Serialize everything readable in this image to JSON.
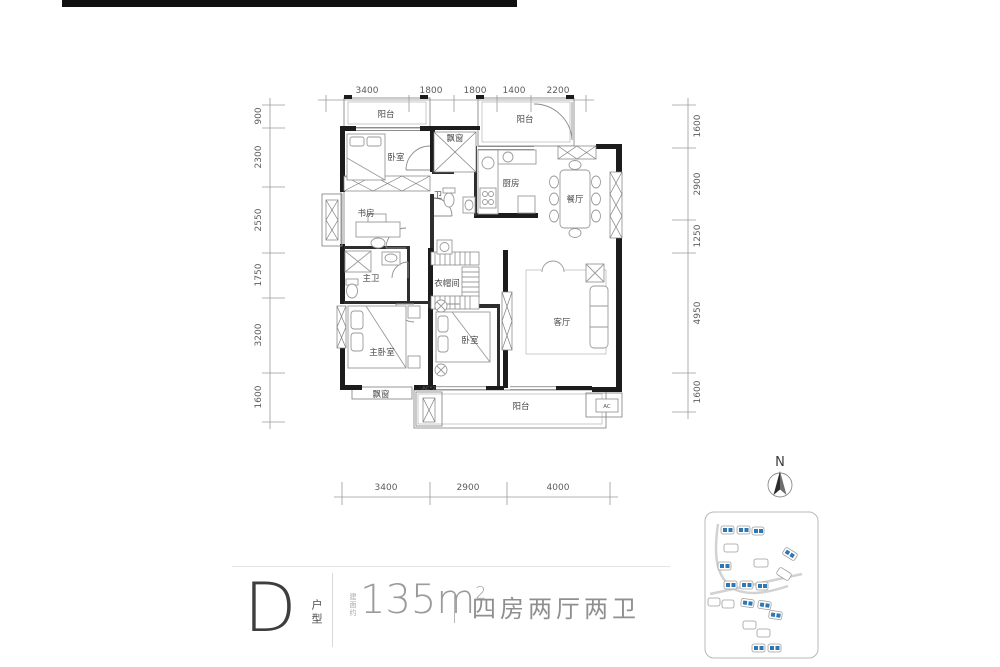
{
  "plan": {
    "rooms": {
      "balcony_top_left": "阳台",
      "bedroom_top": "卧室",
      "bay_window_top": "飘窗",
      "bath": "卫",
      "kitchen": "厨房",
      "balcony_top_right": "阳台",
      "dining": "餐厅",
      "study": "书房",
      "master_bath": "主卫",
      "closet": "衣帽间",
      "master_bedroom": "主卧室",
      "bedroom_mid": "卧室",
      "living": "客厅",
      "bay_window_bottom": "飘窗",
      "balcony_bottom": "阳台",
      "ac_left": "AC*2",
      "ac_right": "AC"
    },
    "dims": {
      "top": [
        "3400",
        "1800",
        "1800",
        "1400",
        "2200"
      ],
      "left": [
        "900",
        "2300",
        "2550",
        "1750",
        "3200",
        "1600"
      ],
      "right": [
        "1600",
        "2900",
        "1250",
        "4950",
        "1600"
      ],
      "bottom": [
        "3400",
        "2900",
        "4000"
      ]
    }
  },
  "info": {
    "unit_letter": "D",
    "unit_label": "户型",
    "area_prefix": "建面约",
    "area_value": "135m",
    "area_exponent": "2",
    "layout_text": "四房两厅两卫"
  },
  "compass": {
    "label": "N"
  },
  "colors": {
    "accent_blue": "#2e77b5",
    "wall": "#1c1c1c"
  }
}
